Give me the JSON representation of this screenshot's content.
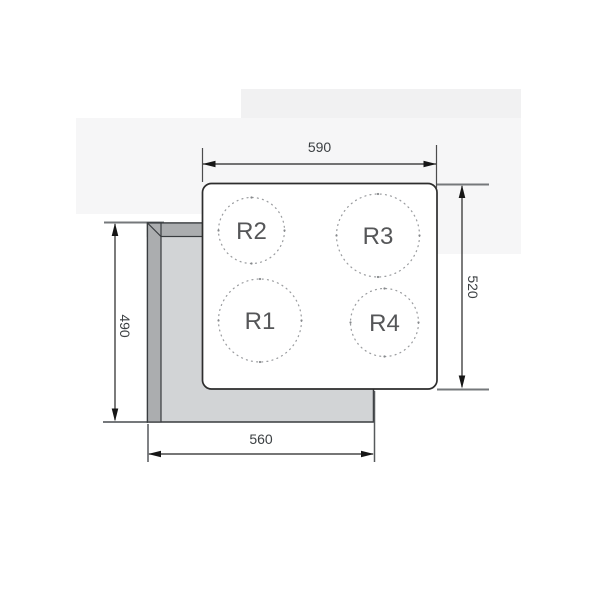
{
  "dimensions": {
    "top": {
      "value": "590",
      "orientation": "horizontal"
    },
    "right": {
      "value": "520",
      "orientation": "vertical"
    },
    "left": {
      "value": "490",
      "orientation": "vertical"
    },
    "bottom": {
      "value": "560",
      "orientation": "horizontal"
    }
  },
  "burners": {
    "r2": {
      "label": "R2"
    },
    "r3": {
      "label": "R3"
    },
    "r1": {
      "label": "R1"
    },
    "r4": {
      "label": "R4"
    }
  },
  "colors": {
    "worktop_fill": "#d2d4d6",
    "worktop_rim": "#abadaf",
    "outline": "#393c3f",
    "dimension_line": "#242424",
    "dotted_circle": "#9b9da0",
    "dimension_text": "#3c4043",
    "burner_text": "#555658",
    "background_artifact": "#f3f3f4"
  }
}
